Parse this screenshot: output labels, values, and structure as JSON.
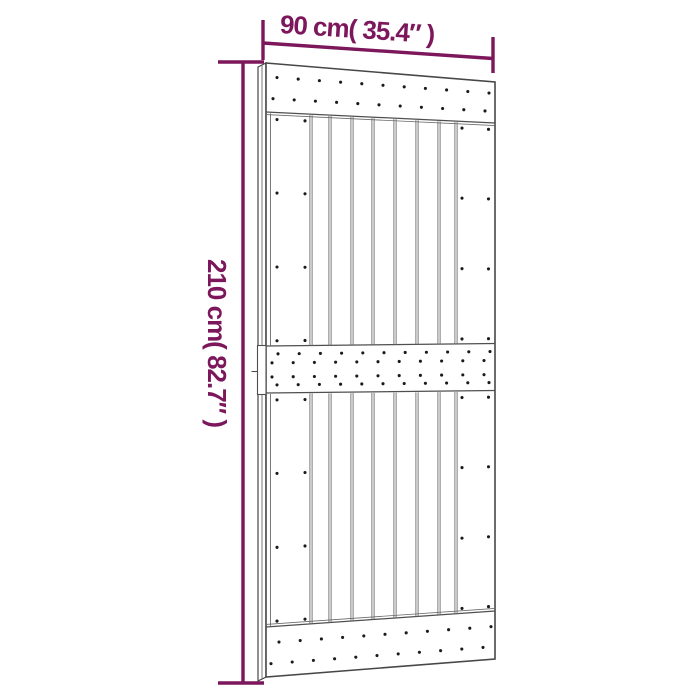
{
  "page": {
    "background": "#ffffff"
  },
  "diagram": {
    "type": "technical-dimension-drawing",
    "dimensions": {
      "width_label": "90 cm( 35.4″ )",
      "height_label": "210 cm( 82.7″ )"
    },
    "colors": {
      "dimension_accent": "#7D175C",
      "door_outline": "#474747",
      "batten_edge": "#4f4f4f",
      "board_line": "#6a6a6a",
      "nail_dot": "#1a1a1a",
      "door_fill": "#ffffff",
      "background": "#ffffff"
    },
    "structure": {
      "battens": 3,
      "planks_between_stiles": 7,
      "nail_rows_top_batten": 2,
      "nail_rows_middle_batten": 4,
      "nail_rows_bottom_batten": 2,
      "nails_per_batten_row": 11,
      "stile_nail_rows_per_section": 4,
      "stile_nail_columns": 2
    }
  }
}
